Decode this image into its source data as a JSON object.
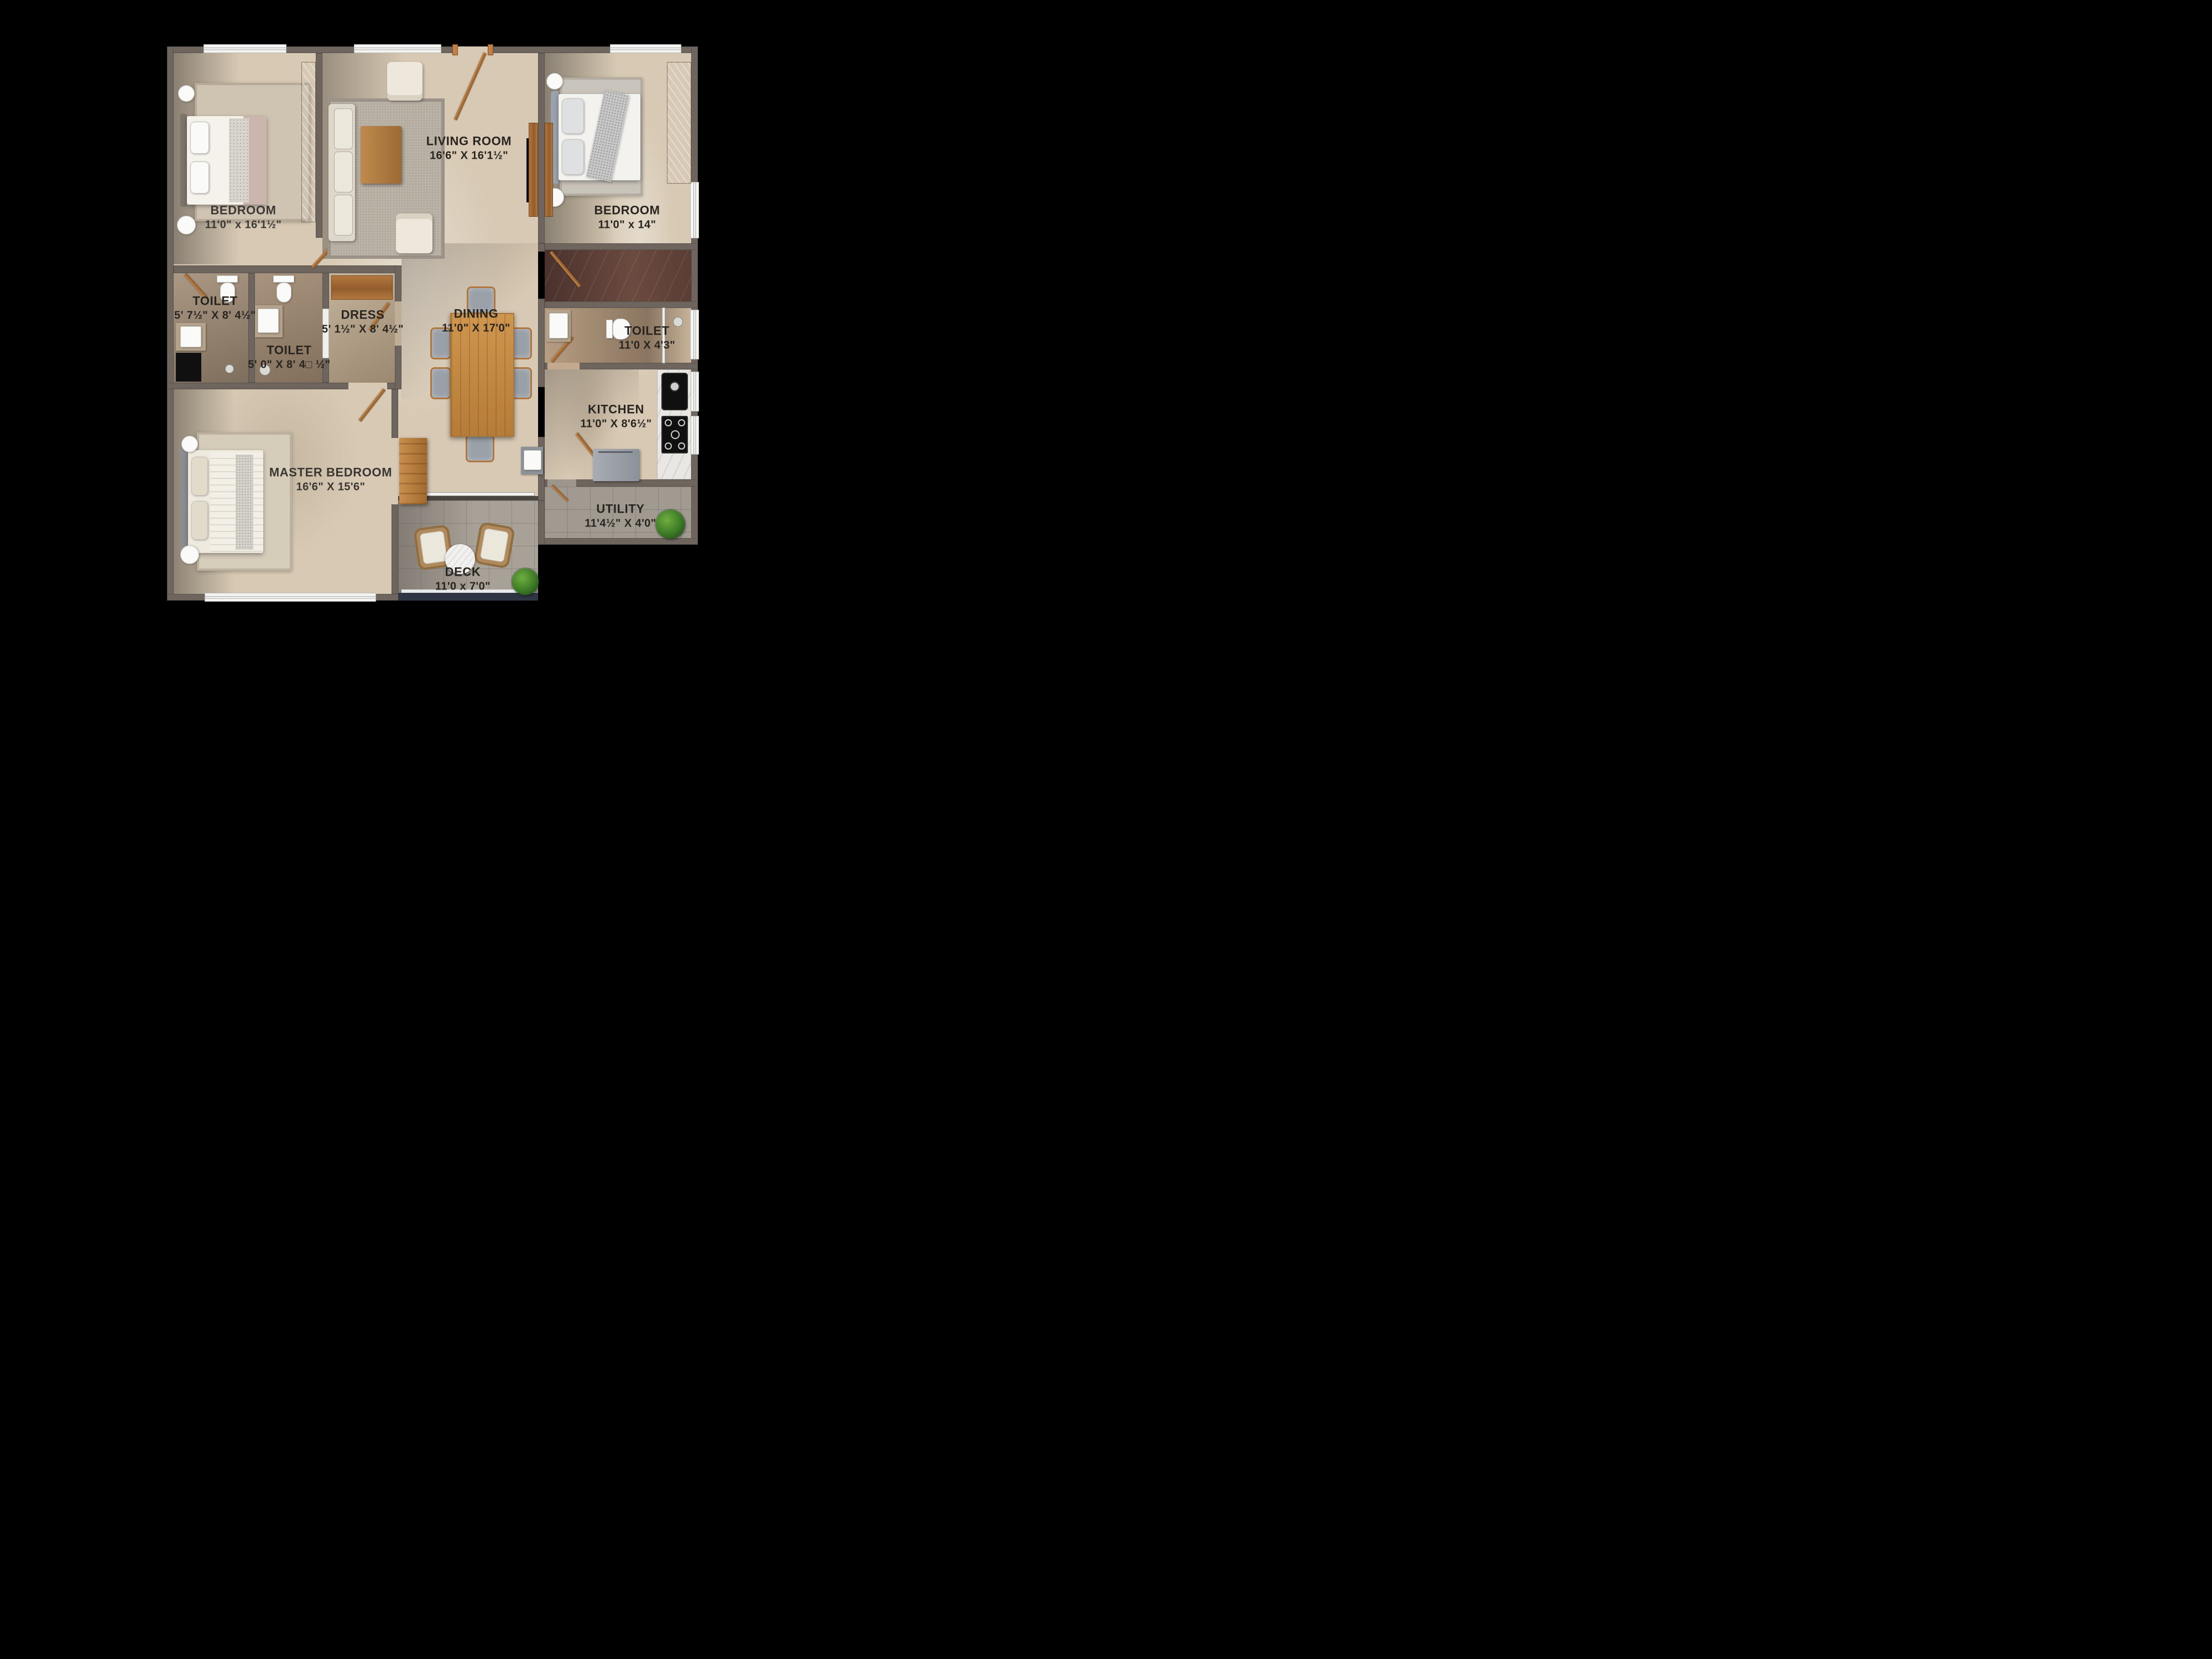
{
  "colors": {
    "background": "#000000",
    "wall": "#6e655e",
    "floor_marble": "#d7c9b3",
    "floor_toilet": "#a6937e",
    "floor_passage_marble": "#5f4038",
    "floor_deck_tile": "#a19a91",
    "wood_accent": "#b5793f",
    "label_text": "#282420",
    "window": "#f4f4f2",
    "deck_rail": "#2f3542"
  },
  "rooms": {
    "living": {
      "name": "LIVING ROOM",
      "dims": "16'6\" X 16'1½\""
    },
    "bedroom_left": {
      "name": "BEDROOM",
      "dims": "11'0\" x 16'1½\""
    },
    "bedroom_right": {
      "name": "BEDROOM",
      "dims": "11'0\" x 14\""
    },
    "toilet_left": {
      "name": "TOILET",
      "dims": "5' 7½\" X 8' 4½\""
    },
    "toilet_mid": {
      "name": "TOILET",
      "dims": "5' 0\" X 8' 4□ ½\""
    },
    "dress": {
      "name": "DRESS",
      "dims": "5' 1½\" X 8' 4½\""
    },
    "dining": {
      "name": "DINING",
      "dims": "11'0\" X 17'0\""
    },
    "toilet_right": {
      "name": "TOILET",
      "dims": "11'0 X 4'3\""
    },
    "kitchen": {
      "name": "KITCHEN",
      "dims": "11'0\" X 8'6½\""
    },
    "master_bedroom": {
      "name": "MASTER BEDROOM",
      "dims": "16'6\" X 15'6\""
    },
    "utility": {
      "name": "UTILITY",
      "dims": "11'4½\" X 4'0\""
    },
    "deck": {
      "name": "DECK",
      "dims": "11'0 x 7'0\""
    }
  }
}
